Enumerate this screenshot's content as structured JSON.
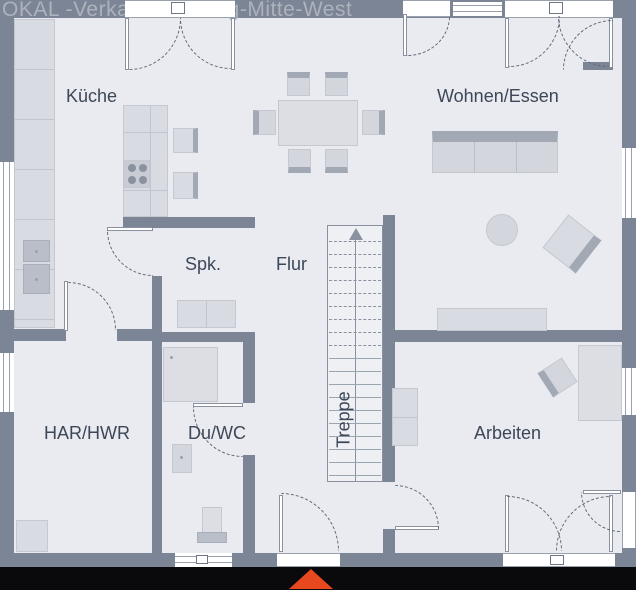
{
  "watermark": "OKAL -Verkauf Siedlung-Mitte-West",
  "rooms": {
    "kueche": "Küche",
    "wohnen_essen": "Wohnen/Essen",
    "spk": "Spk.",
    "flur": "Flur",
    "har_hwr": "HAR/HWR",
    "du_wc": "Du/WC",
    "arbeiten": "Arbeiten"
  },
  "stairs": {
    "label": "Treppe",
    "direction": "up",
    "dashed_treads": 9,
    "solid_treads": 10
  },
  "colors": {
    "floor": "#e9ebf0",
    "wall": "#7c8595",
    "furniture_light": "#d9dbe2",
    "furniture_dark": "#a2a8b4",
    "label_text": "#3d4757",
    "watermark_text": "#adb2bd",
    "entrance_arrow": "#e8481e",
    "footer_band": "#0a0a0c"
  }
}
